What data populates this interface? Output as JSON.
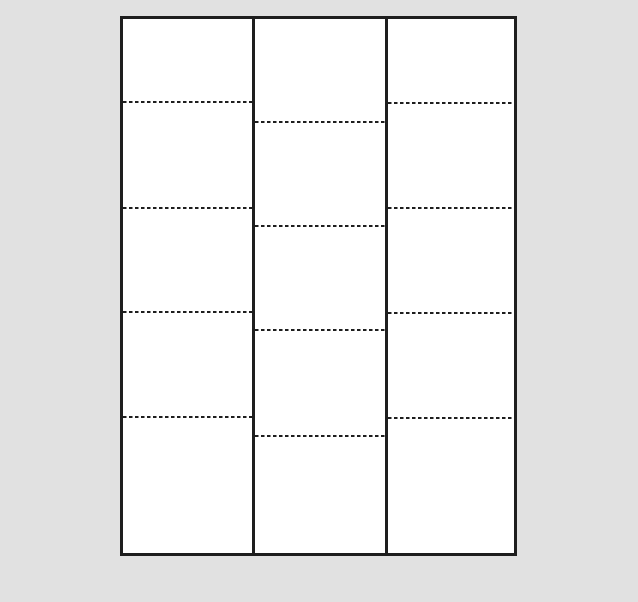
{
  "canvas": {
    "width": 638,
    "height": 602,
    "background_color": "#e1e1e1"
  },
  "sheet": {
    "x": 120,
    "y": 16,
    "width": 397,
    "height": 540,
    "fill_color": "#ffffff",
    "border_color": "#1e1e1e",
    "border_width": 3
  },
  "dividers": {
    "color": "#1e1e1e",
    "width": 3,
    "x_positions": [
      252,
      385
    ]
  },
  "perforations": {
    "color": "#1e1e1e",
    "thickness": 2.5,
    "dash_length": 3.5,
    "gap_length": 2.5,
    "columns": [
      {
        "id": "left",
        "x_start": 123,
        "x_end": 252,
        "y_positions": [
          102,
          208,
          312,
          417
        ]
      },
      {
        "id": "middle",
        "x_start": 255,
        "x_end": 385,
        "y_positions": [
          122,
          226,
          330,
          436
        ]
      },
      {
        "id": "right",
        "x_start": 388,
        "x_end": 514,
        "y_positions": [
          103,
          208,
          313,
          418
        ]
      }
    ]
  }
}
